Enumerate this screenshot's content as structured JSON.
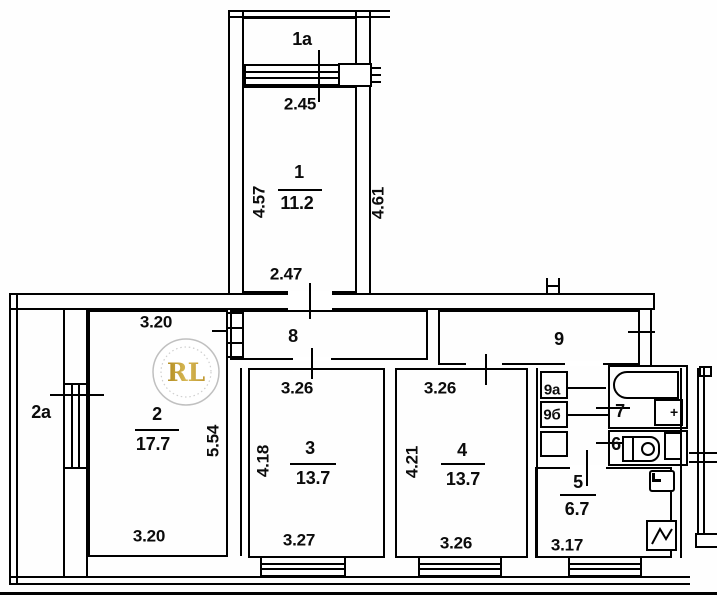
{
  "plan": {
    "watermark": "RL",
    "colors": {
      "watermark_gold": "#c5a13d",
      "watermark_ring": "#c0c0c0",
      "line": "#000000"
    },
    "balcony_1a": {
      "label": "1a",
      "width": "2.45"
    },
    "room_1": {
      "number": "1",
      "area": "11.2",
      "left": "4.57",
      "bottom": "2.47",
      "right_wall": "4.61"
    },
    "balcony_2a": {
      "label": "2a"
    },
    "room_2": {
      "number": "2",
      "area": "17.7",
      "top": "3.20",
      "bottom": "3.20",
      "right": "5.54"
    },
    "corridor_8": {
      "number": "8"
    },
    "corridor_9": {
      "number": "9"
    },
    "room_3": {
      "number": "3",
      "area": "13.7",
      "top": "3.26",
      "left": "4.18",
      "bottom": "3.27"
    },
    "room_4": {
      "number": "4",
      "area": "13.7",
      "top": "3.26",
      "left": "4.21",
      "bottom": "3.26"
    },
    "closet_9a": {
      "label": "9a"
    },
    "closet_9b": {
      "label": "9б"
    },
    "bathroom_7": {
      "number": "7"
    },
    "wc_6": {
      "number": "6"
    },
    "kitchen_5": {
      "number": "5",
      "area": "6.7",
      "bottom": "3.17"
    },
    "sink_plus": "+"
  }
}
